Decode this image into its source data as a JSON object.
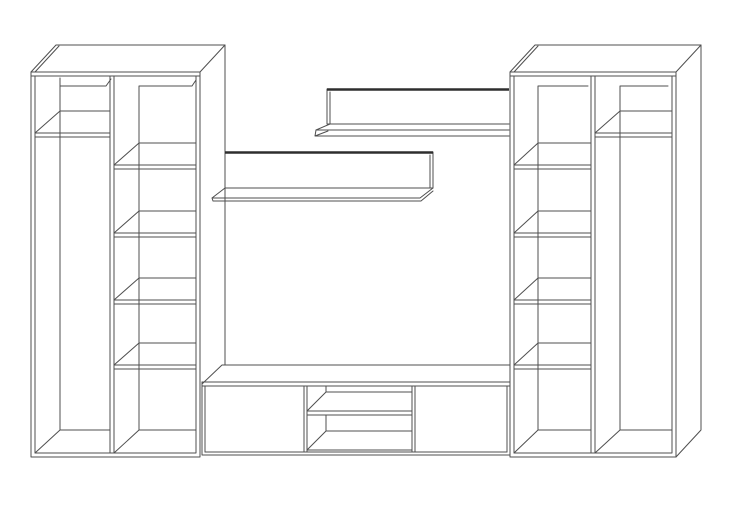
{
  "title": "Wall unit furniture line drawing",
  "canvas": {
    "width": 750,
    "height": 508
  },
  "colors": {
    "background": "#ffffff",
    "line": "#4f4f4f",
    "dark_edge": "#2e2e2e"
  },
  "components": [
    {
      "id": "left-wardrobe",
      "label": "Left wardrobe",
      "sections": [
        {
          "type": "hanging-space",
          "top_shelves": 1
        },
        {
          "type": "shelf-column",
          "compartments": 5
        }
      ]
    },
    {
      "id": "upper-wall-shelf",
      "label": "Upper wall shelf",
      "parts": [
        "back panel",
        "shelf board"
      ]
    },
    {
      "id": "lower-wall-shelf",
      "label": "Lower wall shelf",
      "parts": [
        "back panel",
        "shelf board"
      ]
    },
    {
      "id": "tv-stand",
      "label": "TV stand",
      "doors": 2,
      "open_compartments": 2
    },
    {
      "id": "right-wardrobe",
      "label": "Right wardrobe",
      "sections": [
        {
          "type": "shelf-column",
          "compartments": 5
        },
        {
          "type": "hanging-space",
          "top_shelves": 1
        }
      ]
    }
  ]
}
